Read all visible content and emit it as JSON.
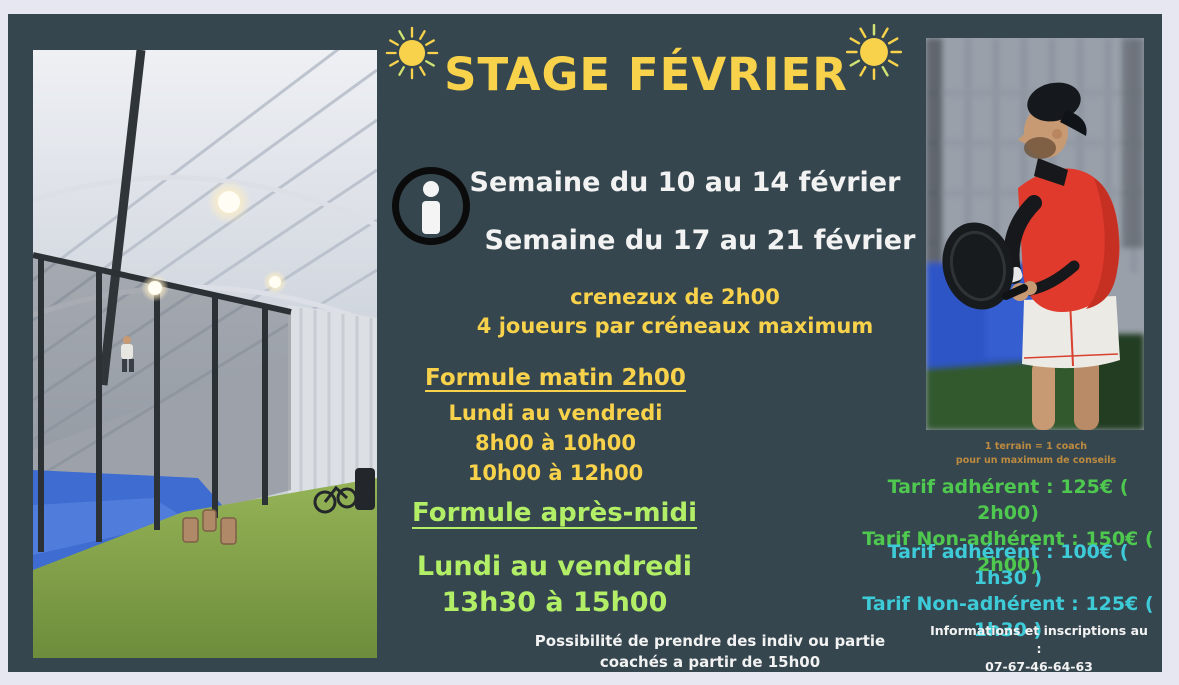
{
  "colors": {
    "page_bg": "#e7e7f1",
    "card_bg": "#35464f",
    "title_yellow": "#f8d24b",
    "white": "#f2f2f2",
    "light_green": "#b2ef66",
    "green": "#4fc84f",
    "cyan": "#3ecbd8",
    "orange_note": "#bd8b3f"
  },
  "icons": {
    "sun_left": "sun-icon",
    "sun_right": "sun-icon",
    "info": "info-icon"
  },
  "header": {
    "title": "STAGE FÉVRIER"
  },
  "weeks": [
    "Semaine du 10 au 14 février",
    "Semaine du 17 au 21 février"
  ],
  "slots": [
    "crenezux de 2h00",
    "4 joueurs par créneaux maximum"
  ],
  "formule_matin": {
    "title": "Formule matin 2h00",
    "lines": [
      "Lundi au vendredi",
      "8h00 à 10h00",
      "10h00 à 12h00"
    ]
  },
  "formule_apres_midi": {
    "title": "Formule après-midi",
    "lines": [
      "Lundi au vendredi",
      "13h30 à 15h00"
    ]
  },
  "note_bottom": [
    "Possibilité de prendre des indiv ou partie",
    "coachés a partir de 15h00"
  ],
  "coach_note": [
    "1 terrain = 1 coach",
    "pour un maximum de conseils"
  ],
  "tarifs_2h00": [
    "Tarif adhérent : 125€ ( 2h00)",
    "Tarif Non-adhérent : 150€ ( 2h00)"
  ],
  "tarifs_1h30": [
    "Tarif adhérent : 100€ ( 1h30 )",
    "Tarif Non-adhérent : 125€ ( 1h30 )"
  ],
  "contact": [
    "Informations et inscriptions au :",
    "07-67-46-64-63"
  ]
}
